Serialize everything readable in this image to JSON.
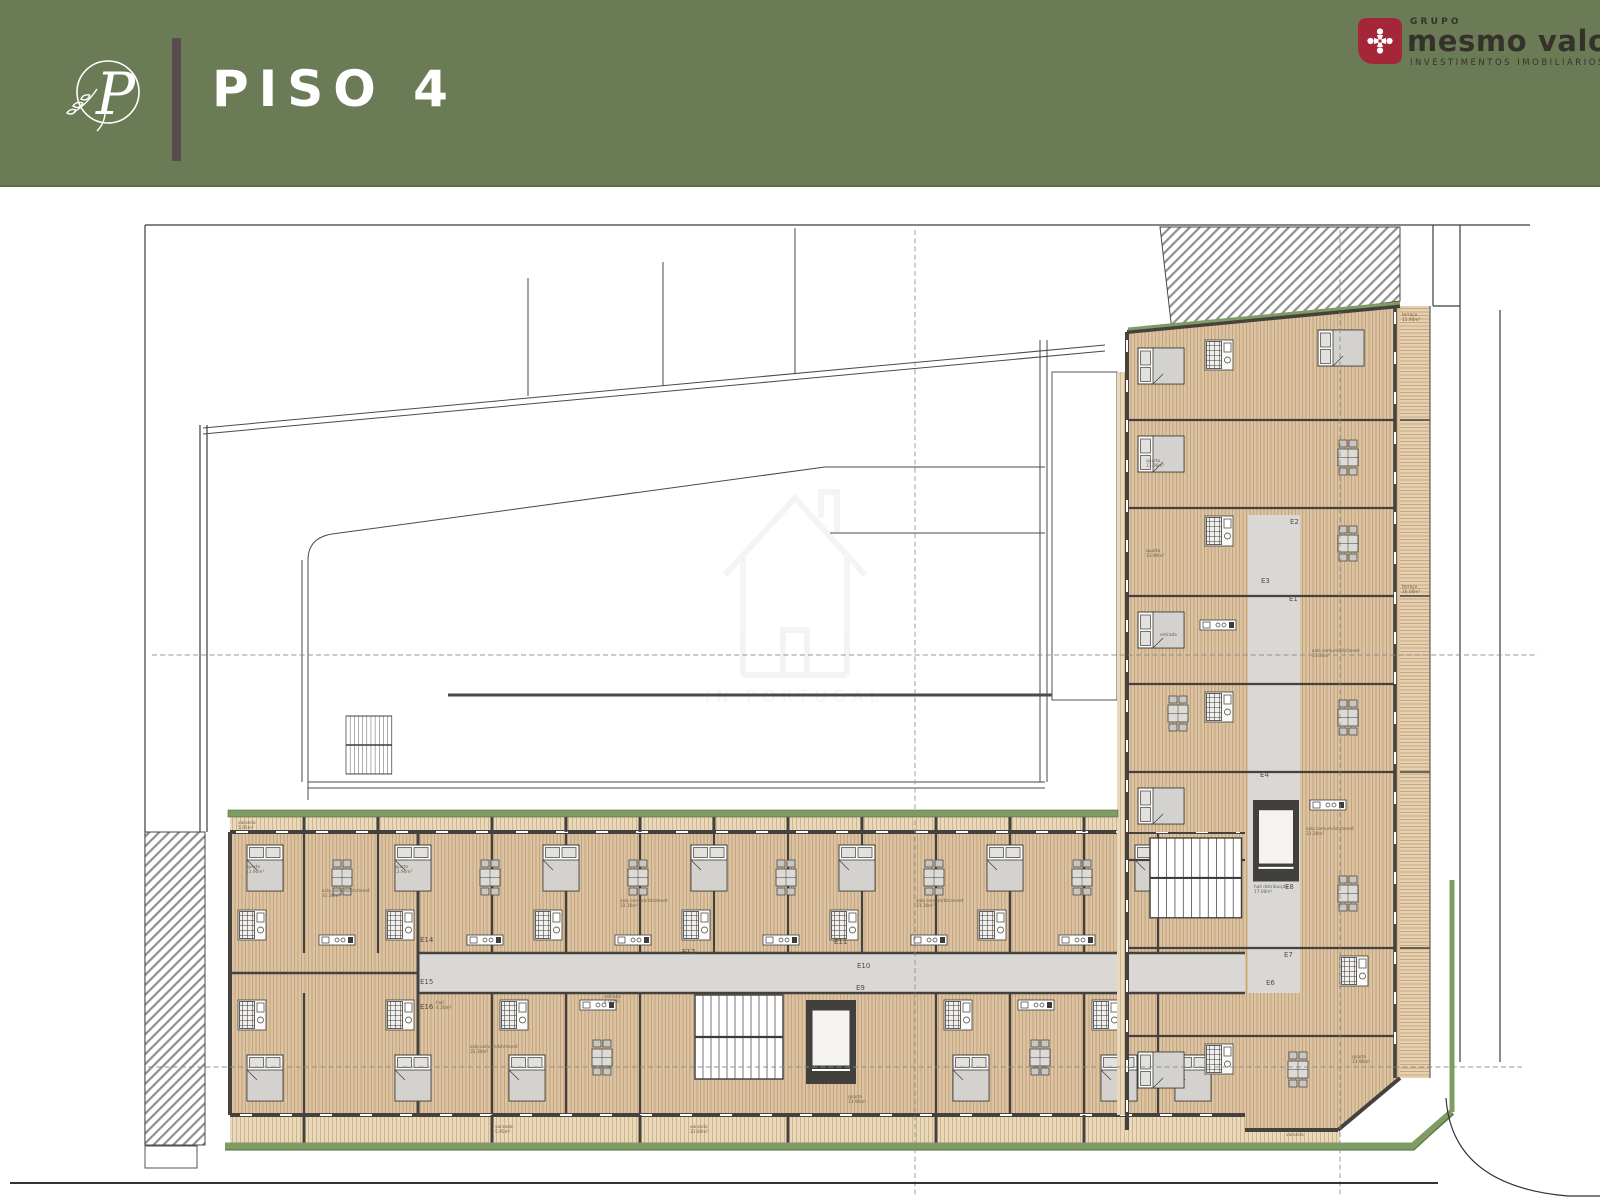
{
  "header": {
    "title": "PISO 4",
    "monogram": "P",
    "brand": {
      "group": "GRUPO",
      "name": "mesmo valor",
      "tagline": "INVESTIMENTOS IMOBILIÁRIOS"
    }
  },
  "plan": {
    "watermark": "IN PORTUGAL",
    "labels": {
      "quarto": "quarto",
      "quarto_area": "13.90m²",
      "sala": "sala comum/kitchenet",
      "sala_area": "31.30m²",
      "varanda": "varanda",
      "varanda_area": "5.95m²",
      "varanda_area_big": "31.60m²",
      "hall": "hall",
      "hall_area": "4.20m²",
      "entrada": "entrada",
      "entrada_area": "4.00m²",
      "hall_dist": "hall distribuição",
      "hall_dist_area": "17.00m²",
      "terraco": "terraço",
      "terraco_area_top": "15.90m²",
      "terraco_area_mid": "26.00m²"
    },
    "units": {
      "e1": "E1",
      "e2": "E2",
      "e3": "E3",
      "e4": "E4",
      "e6": "E6",
      "e7": "E7",
      "e8": "E8",
      "e9": "E9",
      "e10": "E10",
      "e11": "E11",
      "e12": "E12",
      "e14": "E14",
      "e15": "E15",
      "e16": "E16"
    }
  },
  "colors": {
    "header_bg": "#6b7b55",
    "accent_bar": "#5a4b4f",
    "brand_red": "#a52639",
    "brand_text": "#35322a",
    "title": "#ffffff",
    "floor_tan": "#dcc3a3",
    "wall": "#45423e",
    "corridor": "#d9d8d5",
    "green": "#7e9c63",
    "terrace": "#e5d0b2"
  }
}
